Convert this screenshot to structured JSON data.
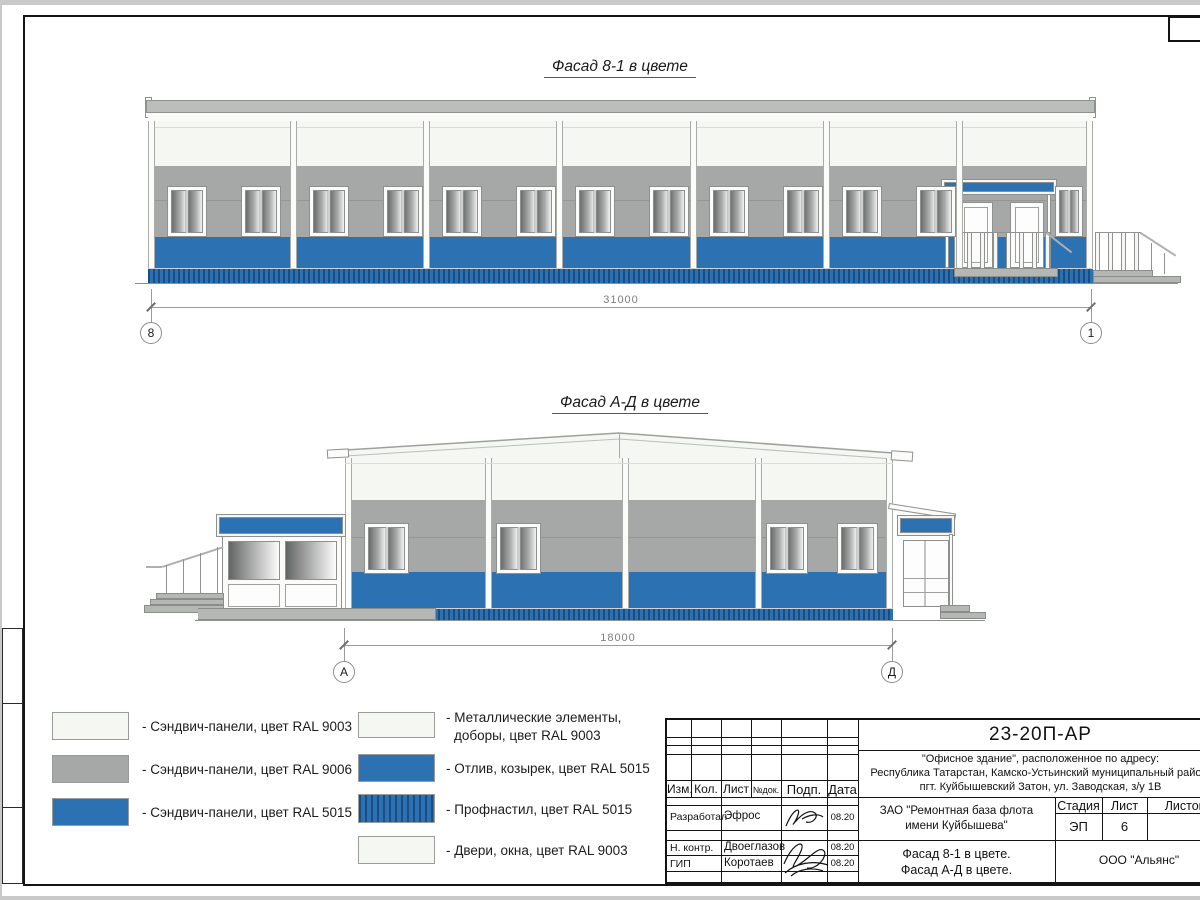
{
  "facade1": {
    "title": "Фасад 8-1 в цвете",
    "dim": "31000",
    "axis_left": "8",
    "axis_right": "1"
  },
  "facade2": {
    "title": "Фасад А-Д в цвете",
    "dim": "18000",
    "axis_left": "А",
    "axis_right": "Д"
  },
  "legend": {
    "left": [
      {
        "swatch": "ral9003-offwhite",
        "label": "- Сэндвич-панели, цвет RAL 9003"
      },
      {
        "swatch": "ral9006-gray",
        "label": "- Сэндвич-панели, цвет RAL 9006"
      },
      {
        "swatch": "ral5015-blue",
        "label": "- Сэндвич-панели, цвет RAL 5015"
      }
    ],
    "right": [
      {
        "swatch": "ral9003-offwhite",
        "label1": "- Металлические элементы,",
        "label2": "доборы, цвет RAL 9003"
      },
      {
        "swatch": "ral5015-blue",
        "label1": "- Отлив, козырек, цвет RAL 5015",
        "label2": ""
      },
      {
        "swatch": "ral5015-stripes",
        "label1": "- Профнастил, цвет RAL 5015",
        "label2": ""
      },
      {
        "swatch": "ral9003-offwhite",
        "label1": "- Двери, окна, цвет RAL 9003",
        "label2": ""
      }
    ]
  },
  "titleblock": {
    "doc_number": "23-20П-АР",
    "address1": "\"Офисное здание\", расположенное по адресу:",
    "address2": "Республика Татарстан, Камско-Устьинский муниципальный район,",
    "address3": "пгт. Куйбышевский Затон, ул. Заводская, з/у 1В",
    "col_izm": "Изм.",
    "col_kol": "Кол.",
    "col_list": "Лист",
    "col_doc": "№док.",
    "col_podp": "Подп.",
    "col_data": "Дата",
    "row1_role": "Разработал",
    "row1_name": "Эфрос",
    "row1_date": "08.20",
    "row2_role": "Н. контр.",
    "row2_name": "Двоеглазов",
    "row2_date": "08.20",
    "row3_role": "ГИП",
    "row3_name": "Коротаев",
    "row3_date": "08.20",
    "company1": "ЗАО \"Ремонтная база флота",
    "company2": "имени Куйбышева\"",
    "subject1": "Фасад 8-1 в цвете.",
    "subject2": "Фасад А-Д в цвете.",
    "stage_label": "Стадия",
    "list_label": "Лист",
    "listov_label": "Листов",
    "stage_value": "ЭП",
    "list_value": "6",
    "org": "ООО \"Альянс\""
  },
  "colors": {
    "blue_ral5015": "#2c72b3",
    "blue_dark": "#1a4e83",
    "gray_ral9006": "#a6a8a7",
    "offwhite_ral9003": "#f5f7f3",
    "outline": "#8e908f"
  },
  "drawing": {
    "f1_windows": [
      {
        "x": 20
      },
      {
        "x": 94
      },
      {
        "x": 162
      },
      {
        "x": 236
      },
      {
        "x": 295
      },
      {
        "x": 369
      },
      {
        "x": 428
      },
      {
        "x": 502
      },
      {
        "x": 562
      },
      {
        "x": 636
      },
      {
        "x": 695
      },
      {
        "x": 769
      },
      {
        "x": 908,
        "w": 26
      }
    ],
    "f1_pilasters": [
      0,
      142,
      275,
      408,
      542,
      675,
      808,
      938
    ],
    "f2_windows": [
      {
        "x": 20,
        "w": 43
      },
      {
        "x": 152,
        "w": 43
      },
      {
        "x": 422,
        "w": 40
      },
      {
        "x": 493,
        "w": 39
      }
    ],
    "f2_pilasters": [
      0,
      140,
      277,
      410,
      541
    ]
  }
}
